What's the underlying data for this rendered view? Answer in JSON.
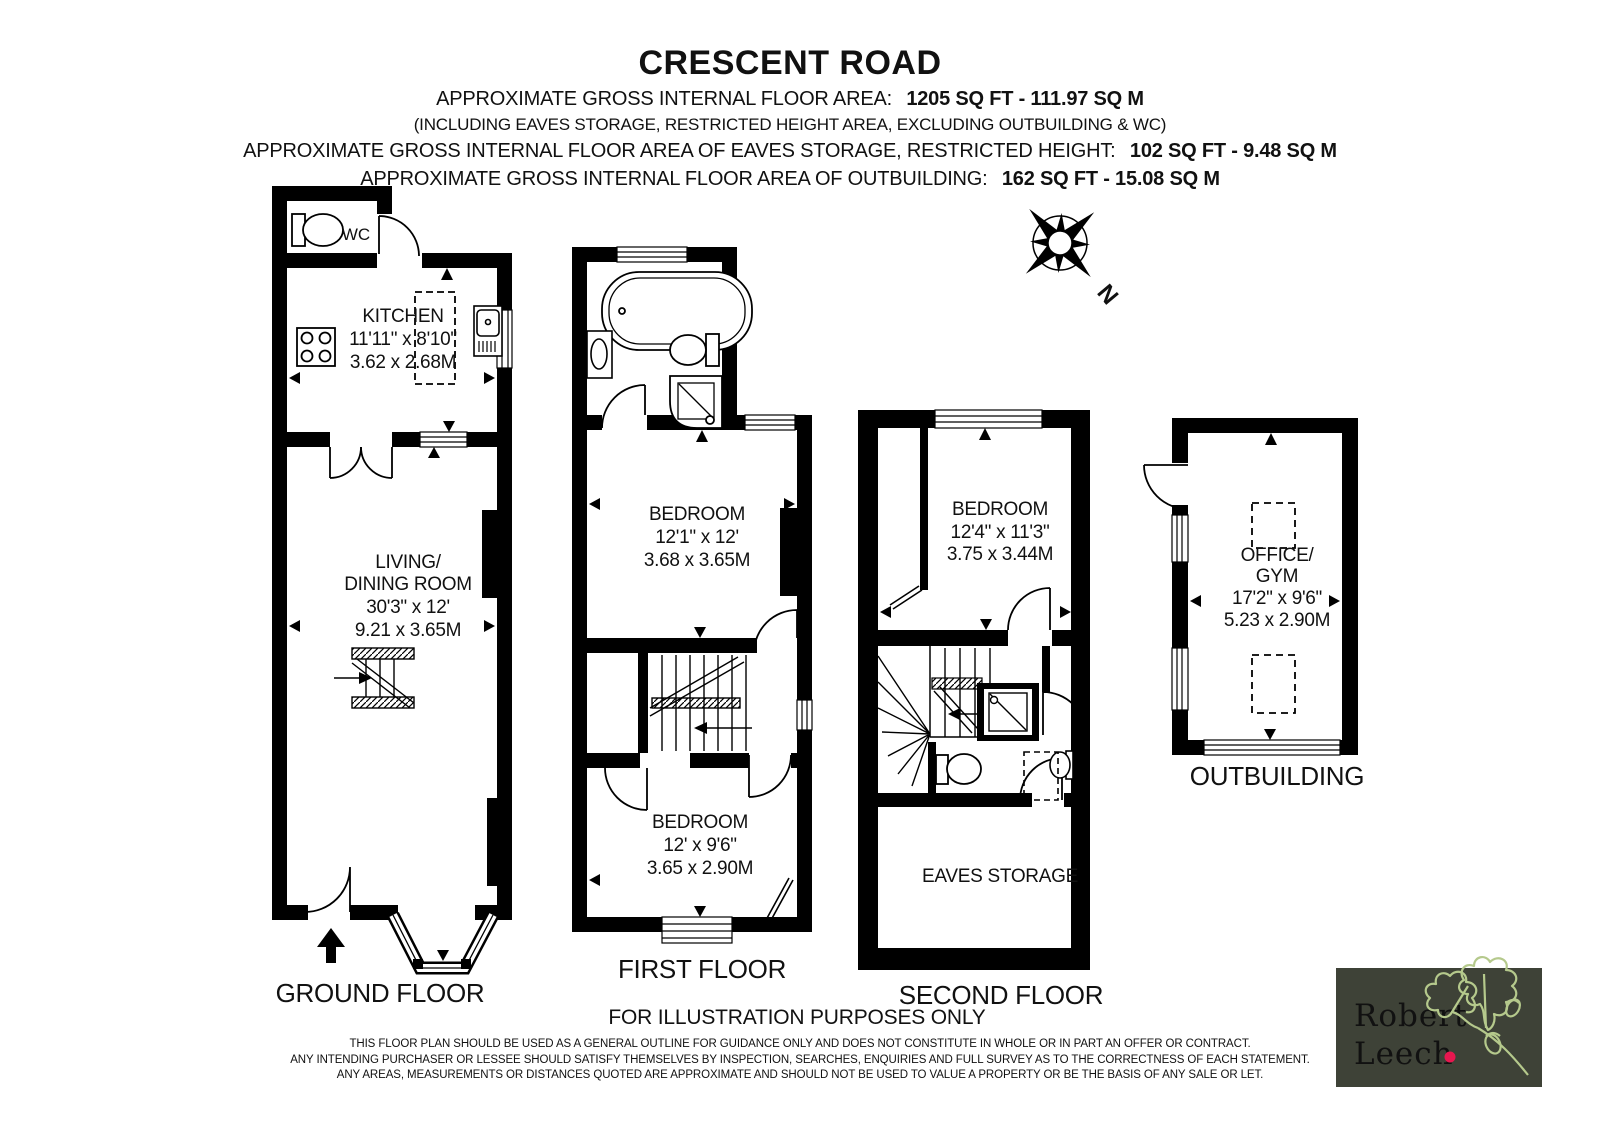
{
  "header": {
    "title": "CRESCENT ROAD",
    "area_line": {
      "label": "APPROXIMATE GROSS INTERNAL FLOOR AREA:",
      "value": "1205 SQ FT - 111.97 SQ M"
    },
    "note_line": "(INCLUDING EAVES STORAGE, RESTRICTED HEIGHT AREA, EXCLUDING OUTBUILDING & WC)",
    "eaves_line": {
      "label": "APPROXIMATE GROSS INTERNAL FLOOR AREA OF EAVES STORAGE, RESTRICTED HEIGHT:",
      "value": "102 SQ FT - 9.48 SQ M"
    },
    "outbuilding_line": {
      "label": "APPROXIMATE GROSS INTERNAL FLOOR AREA OF OUTBUILDING:",
      "value": "162 SQ FT - 15.08 SQ M"
    }
  },
  "floors": {
    "ground": {
      "label": "GROUND FLOOR",
      "wc_label": "WC",
      "kitchen": {
        "name": "KITCHEN",
        "imperial": "11'11\" x 8'10\"",
        "metric": "3.62 x 2.68M"
      },
      "living": {
        "name_line1": "LIVING/",
        "name_line2": "DINING ROOM",
        "imperial": "30'3\" x 12'",
        "metric": "9.21 x 3.65M"
      }
    },
    "first": {
      "label": "FIRST FLOOR",
      "bedroom1": {
        "name": "BEDROOM",
        "imperial": "12'1\" x 12'",
        "metric": "3.68 x 3.65M"
      },
      "bedroom2": {
        "name": "BEDROOM",
        "imperial": "12' x 9'6\"",
        "metric": "3.65 x 2.90M"
      }
    },
    "second": {
      "label": "SECOND FLOOR",
      "bedroom": {
        "name": "BEDROOM",
        "imperial": "12'4\" x 11'3\"",
        "metric": "3.75 x 3.44M"
      },
      "eaves_label": "EAVES STORAGE"
    },
    "outbuilding": {
      "label": "OUTBUILDING",
      "office": {
        "name_line1": "OFFICE/",
        "name_line2": "GYM",
        "imperial": "17'2\" x 9'6\"",
        "metric": "5.23 x 2.90M"
      }
    }
  },
  "compass": {
    "north": "N"
  },
  "footer": {
    "illustration": "FOR ILLUSTRATION PURPOSES ONLY",
    "disclaimer1": "THIS FLOOR PLAN SHOULD BE USED AS A GENERAL OUTLINE FOR GUIDANCE ONLY AND DOES NOT CONSTITUTE IN WHOLE OR IN PART AN OFFER OR CONTRACT.",
    "disclaimer2": "ANY INTENDING PURCHASER OR LESSEE SHOULD SATISFY THEMSELVES BY INSPECTION, SEARCHES, ENQUIRIES AND FULL SURVEY AS TO THE CORRECTNESS OF EACH STATEMENT.",
    "disclaimer3": "ANY AREAS, MEASUREMENTS OR DISTANCES QUOTED ARE APPROXIMATE AND SHOULD NOT BE USED TO VALUE A PROPERTY OR BE THE BASIS OF ANY SALE OR LET."
  },
  "logo": {
    "name_line1": "Robert",
    "name_line2": "Leech",
    "colors": {
      "box_bg": "#3e4237",
      "text": "#f6f2e4",
      "dot": "#e8174f",
      "leaf": "#b5c98c"
    }
  }
}
